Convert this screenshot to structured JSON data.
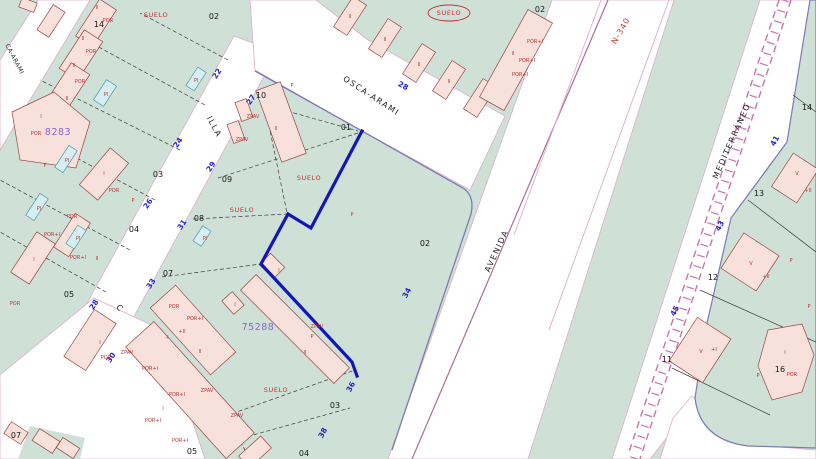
{
  "map": {
    "colors": {
      "block_fill": "#cfe1d7",
      "road_fill": "#ffffff",
      "building_fill": "#f8e1da",
      "building_stroke": "#9a4343",
      "pool_fill": "#d6edf1",
      "selected_parcel_outline": "#1414b8",
      "street_number_color": "#2323cb",
      "zone_label_color": "#c22f2f",
      "reference_label_color": "#8f63cc",
      "highway_label_color": "#c23a3a",
      "railway_color": "#c973ab"
    },
    "streets": [
      {
        "label": "OSCA-ARAMI",
        "x": 370,
        "y": 98,
        "rot": 33,
        "kind": "street"
      },
      {
        "label": "ILLA",
        "x": 212,
        "y": 128,
        "rot": 62,
        "kind": "street"
      },
      {
        "label": "C",
        "x": 118,
        "y": 310,
        "rot": 50,
        "kind": "street"
      },
      {
        "label": "AVENIDA",
        "x": 499,
        "y": 252,
        "rot": -65,
        "kind": "street"
      },
      {
        "label": "N-340",
        "x": 623,
        "y": 32,
        "rot": -60,
        "kind": "highway"
      },
      {
        "label": "MEDITERRÁNEO",
        "x": 734,
        "y": 142,
        "rot": -66,
        "kind": "street"
      },
      {
        "label": "CA-ARAMI",
        "x": 13,
        "y": 60,
        "rot": 62,
        "kind": "street-small"
      }
    ],
    "street_numbers": [
      {
        "n": "22",
        "x": 219,
        "y": 75,
        "rot": -56
      },
      {
        "n": "24",
        "x": 180,
        "y": 144,
        "rot": -56
      },
      {
        "n": "26",
        "x": 150,
        "y": 205,
        "rot": -56
      },
      {
        "n": "28",
        "x": 96,
        "y": 306,
        "rot": -56
      },
      {
        "n": "30",
        "x": 113,
        "y": 359,
        "rot": -56
      },
      {
        "n": "27",
        "x": 253,
        "y": 101,
        "rot": -56
      },
      {
        "n": "29",
        "x": 213,
        "y": 168,
        "rot": -56
      },
      {
        "n": "31",
        "x": 184,
        "y": 226,
        "rot": -56
      },
      {
        "n": "33",
        "x": 153,
        "y": 285,
        "rot": -56
      },
      {
        "n": "28",
        "x": 402,
        "y": 88,
        "rot": 28
      },
      {
        "n": "34",
        "x": 409,
        "y": 294,
        "rot": -62
      },
      {
        "n": "36",
        "x": 353,
        "y": 388,
        "rot": -62
      },
      {
        "n": "38",
        "x": 325,
        "y": 434,
        "rot": -62
      },
      {
        "n": "41",
        "x": 777,
        "y": 142,
        "rot": -62
      },
      {
        "n": "43",
        "x": 722,
        "y": 227,
        "rot": -62
      },
      {
        "n": "45",
        "x": 677,
        "y": 312,
        "rot": -62
      }
    ],
    "parcel_numbers": [
      {
        "n": "02",
        "x": 214,
        "y": 19
      },
      {
        "n": "14",
        "x": 99,
        "y": 27
      },
      {
        "n": "03",
        "x": 158,
        "y": 177
      },
      {
        "n": "04",
        "x": 134,
        "y": 232
      },
      {
        "n": "05",
        "x": 69,
        "y": 297
      },
      {
        "n": "10",
        "x": 261,
        "y": 98
      },
      {
        "n": "09",
        "x": 227,
        "y": 182
      },
      {
        "n": "08",
        "x": 199,
        "y": 221
      },
      {
        "n": "07",
        "x": 168,
        "y": 276
      },
      {
        "n": "01",
        "x": 346,
        "y": 130
      },
      {
        "n": "02",
        "x": 540,
        "y": 12
      },
      {
        "n": "02",
        "x": 425,
        "y": 246
      },
      {
        "n": "03",
        "x": 335,
        "y": 408
      },
      {
        "n": "04",
        "x": 304,
        "y": 456
      },
      {
        "n": "05",
        "x": 192,
        "y": 454
      },
      {
        "n": "14",
        "x": 807,
        "y": 110
      },
      {
        "n": "13",
        "x": 759,
        "y": 196
      },
      {
        "n": "12",
        "x": 713,
        "y": 280
      },
      {
        "n": "11",
        "x": 667,
        "y": 362
      },
      {
        "n": "16",
        "x": 780,
        "y": 372
      },
      {
        "n": "07",
        "x": 16,
        "y": 438
      }
    ],
    "zone_labels": [
      {
        "t": "SUELO",
        "x": 156,
        "y": 17,
        "circled": false
      },
      {
        "t": "SUELO",
        "x": 449,
        "y": 15,
        "circled": true
      },
      {
        "t": "SUELO",
        "x": 309,
        "y": 180,
        "circled": false
      },
      {
        "t": "SUELO",
        "x": 242,
        "y": 212,
        "circled": false
      },
      {
        "t": "SUELO",
        "x": 276,
        "y": 392,
        "circled": false
      }
    ],
    "ref_labels": [
      {
        "t": "75288",
        "x": 258,
        "y": 330
      },
      {
        "t": "8283",
        "x": 58,
        "y": 135
      }
    ],
    "building_labels": [
      {
        "t": "II",
        "x": 97,
        "y": 9
      },
      {
        "t": "POR",
        "x": 108,
        "y": 22
      },
      {
        "t": "II",
        "x": 83,
        "y": 40
      },
      {
        "t": "POR",
        "x": 91,
        "y": 53
      },
      {
        "t": "II",
        "x": 74,
        "y": 67
      },
      {
        "t": "POR",
        "x": 80,
        "y": 83
      },
      {
        "t": "II",
        "x": 67,
        "y": 100
      },
      {
        "t": "I",
        "x": 41,
        "y": 118
      },
      {
        "t": "POR",
        "x": 36,
        "y": 135
      },
      {
        "t": "PI",
        "x": 196,
        "y": 82
      },
      {
        "t": "PI",
        "x": 106,
        "y": 96
      },
      {
        "t": "P",
        "x": 133,
        "y": 202
      },
      {
        "t": "I",
        "x": 104,
        "y": 175
      },
      {
        "t": "POR",
        "x": 114,
        "y": 192
      },
      {
        "t": "PI",
        "x": 67,
        "y": 162
      },
      {
        "t": "P",
        "x": 45,
        "y": 167
      },
      {
        "t": "PI",
        "x": 39,
        "y": 210
      },
      {
        "t": "POR",
        "x": 72,
        "y": 218
      },
      {
        "t": "POR+I",
        "x": 52,
        "y": 236
      },
      {
        "t": "PI",
        "x": 78,
        "y": 240
      },
      {
        "t": "I",
        "x": 34,
        "y": 261
      },
      {
        "t": "POR+I",
        "x": 78,
        "y": 259
      },
      {
        "t": "II",
        "x": 97,
        "y": 260
      },
      {
        "t": "I",
        "x": 100,
        "y": 344
      },
      {
        "t": "POR",
        "x": 106,
        "y": 359
      },
      {
        "t": "POR",
        "x": 15,
        "y": 305
      },
      {
        "t": "ZPAV",
        "x": 253,
        "y": 118
      },
      {
        "t": "ZPAV",
        "x": 242,
        "y": 141
      },
      {
        "t": "II",
        "x": 276,
        "y": 130
      },
      {
        "t": "P",
        "x": 292,
        "y": 87
      },
      {
        "t": "PI",
        "x": 205,
        "y": 240
      },
      {
        "t": "I",
        "x": 235,
        "y": 306
      },
      {
        "t": "POR",
        "x": 174,
        "y": 308
      },
      {
        "t": "POR+I",
        "x": 195,
        "y": 320
      },
      {
        "t": "+II",
        "x": 182,
        "y": 333
      },
      {
        "t": "-I",
        "x": 167,
        "y": 339
      },
      {
        "t": "II",
        "x": 200,
        "y": 353
      },
      {
        "t": "I",
        "x": 279,
        "y": 272
      },
      {
        "t": "ZPAV",
        "x": 317,
        "y": 328
      },
      {
        "t": "P",
        "x": 312,
        "y": 338
      },
      {
        "t": "II",
        "x": 305,
        "y": 354
      },
      {
        "t": "ZPAV",
        "x": 127,
        "y": 354
      },
      {
        "t": "POR+I",
        "x": 150,
        "y": 370
      },
      {
        "t": "POR+I",
        "x": 177,
        "y": 396
      },
      {
        "t": "I",
        "x": 163,
        "y": 410
      },
      {
        "t": "POR+I",
        "x": 153,
        "y": 422
      },
      {
        "t": "ZPAV",
        "x": 207,
        "y": 392
      },
      {
        "t": "ZPAV",
        "x": 237,
        "y": 417
      },
      {
        "t": "POR+I",
        "x": 180,
        "y": 442
      },
      {
        "t": "II",
        "x": 350,
        "y": 18
      },
      {
        "t": "II",
        "x": 385,
        "y": 41
      },
      {
        "t": "II",
        "x": 419,
        "y": 66
      },
      {
        "t": "II",
        "x": 449,
        "y": 83
      },
      {
        "t": "II",
        "x": 513,
        "y": 55
      },
      {
        "t": "POR+I",
        "x": 535,
        "y": 43
      },
      {
        "t": "POR+I",
        "x": 527,
        "y": 62
      },
      {
        "t": "POR+I",
        "x": 520,
        "y": 76
      },
      {
        "t": "P",
        "x": 352,
        "y": 216
      },
      {
        "t": "V",
        "x": 751,
        "y": 265
      },
      {
        "t": "+II",
        "x": 766,
        "y": 278
      },
      {
        "t": "P",
        "x": 791,
        "y": 262
      },
      {
        "t": "V",
        "x": 701,
        "y": 353
      },
      {
        "t": "+I",
        "x": 714,
        "y": 351
      },
      {
        "t": "I",
        "x": 785,
        "y": 354
      },
      {
        "t": "POR",
        "x": 792,
        "y": 376
      },
      {
        "t": "P",
        "x": 809,
        "y": 308
      },
      {
        "t": "P",
        "x": 758,
        "y": 377
      },
      {
        "t": "V",
        "x": 797,
        "y": 175
      },
      {
        "t": "+II",
        "x": 808,
        "y": 192
      }
    ]
  }
}
